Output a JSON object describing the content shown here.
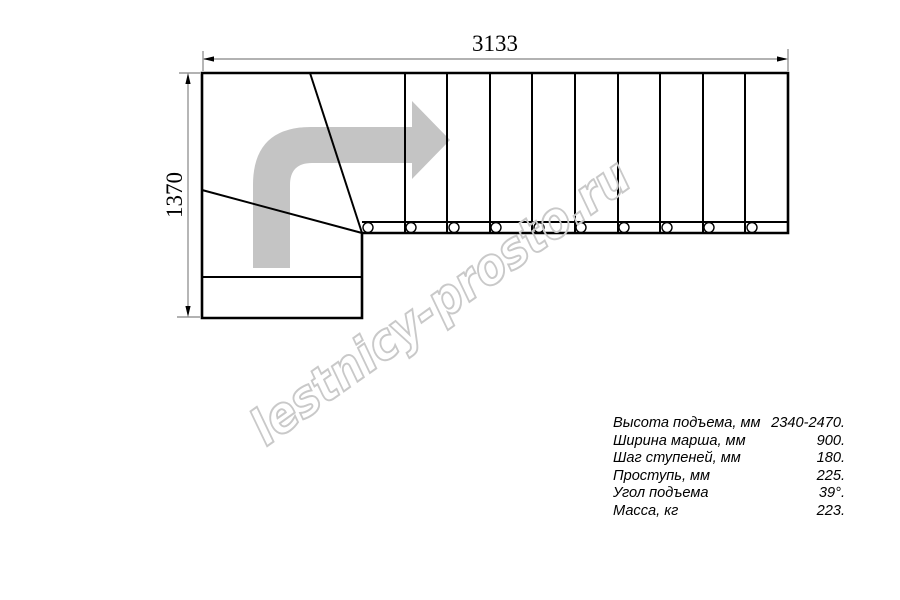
{
  "drawing": {
    "type": "staircase-plan-top-view",
    "dimensions": {
      "width_label": "3133",
      "height_label": "1370"
    },
    "watermark": "lestnicy-prosto.ru",
    "specs": {
      "rows": [
        {
          "label": "Высота подъема, мм",
          "value": "2340-2470."
        },
        {
          "label": "Ширина марша, мм",
          "value": "900."
        },
        {
          "label": "Шаг ступеней, мм",
          "value": "180."
        },
        {
          "label": "Проступь, мм",
          "value": "225."
        },
        {
          "label": "Угол подъема",
          "value": "39°."
        },
        {
          "label": "Масса, кг",
          "value": "223."
        }
      ]
    },
    "colors": {
      "line": "#000000",
      "dimension_line": "#858585",
      "arrow_fill": "#c4c4c4",
      "watermark_stroke": "#c9c9c9",
      "background": "#ffffff"
    }
  }
}
